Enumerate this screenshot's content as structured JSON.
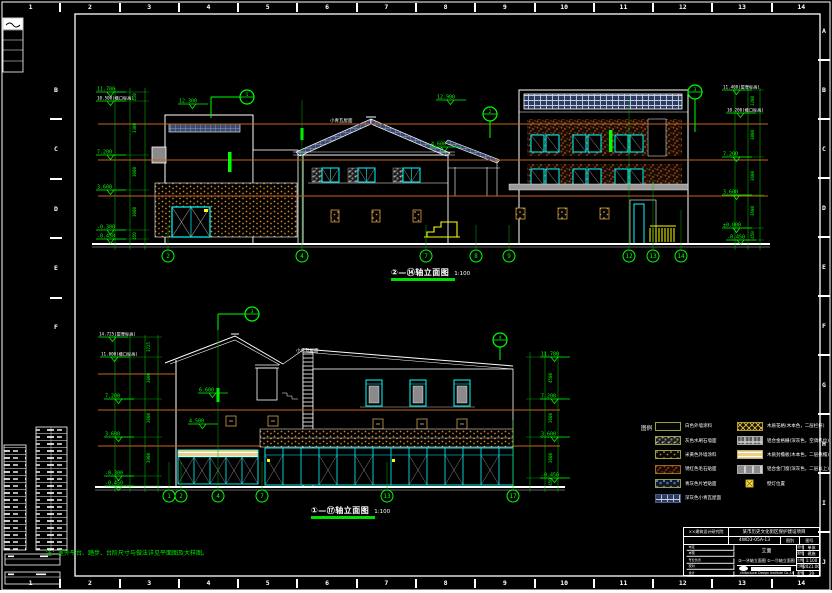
{
  "sheet": {
    "ruler_numbers": [
      "1",
      "2",
      "3",
      "4",
      "5",
      "6",
      "7",
      "8",
      "9",
      "10",
      "11",
      "12",
      "13",
      "14"
    ],
    "right_letters": [
      "A",
      "B",
      "C",
      "D",
      "E",
      "F",
      "G",
      "H",
      "I",
      "J"
    ],
    "left_letters": [
      "B",
      "C",
      "D",
      "E",
      "F"
    ]
  },
  "note": "注：室外平台、踏步、台阶尺寸与做法详见平面图及大样图。",
  "colors": {
    "annotation_green": "#00ff00",
    "window_cyan": "#00ffff",
    "floor_line_orange": "#c8641e",
    "highlight_yellow": "#ffff00"
  },
  "top_elevation": {
    "title": "②—⑭轴立面图",
    "scale": "1:100",
    "roof_label": "小青瓦屋面",
    "left_levels": [
      "11.700",
      "10.500(檐口标高)",
      "7.200",
      "3.600",
      "-0.300",
      "-0.450"
    ],
    "right_levels": [
      "11.400(屋脊标高)",
      "10.200(檐口标高)",
      "7.200",
      "3.600",
      "±0.000",
      "-0.450"
    ],
    "mid_levels": [
      "12.300",
      "12.900",
      "4.600"
    ],
    "left_dims": [
      "450",
      "3300",
      "3600",
      "3600",
      "450"
    ],
    "right_dims": [
      "1200",
      "3000",
      "3600",
      "3600",
      "450"
    ],
    "axis_labels": [
      "2",
      "4",
      "7",
      "8",
      "9",
      "12",
      "13",
      "14"
    ],
    "callout_labels": [
      "1",
      "2",
      "3"
    ]
  },
  "bottom_elevation": {
    "title": "①—⑰轴立面图",
    "scale": "1:100",
    "roof_label": "小青瓦屋面",
    "left_levels": [
      "14.725(屋脊标高)",
      "11.000(檐口标高)",
      "7.200",
      "3.600",
      "-0.300",
      "-0.450"
    ],
    "right_levels": [
      "11.700",
      "7.200",
      "3.600",
      "-0.450"
    ],
    "mid_levels": [
      "6.600",
      "4.500"
    ],
    "left_dims": [
      "3725",
      "3800",
      "3600",
      "3900"
    ],
    "right_dims": [
      "4500",
      "3600",
      "3600",
      "450"
    ],
    "axis_labels": [
      "1",
      "2",
      "4",
      "7",
      "13",
      "17"
    ],
    "callout_labels": [
      "3",
      "4"
    ]
  },
  "legend": {
    "title": "图例",
    "left": [
      {
        "swatch": "plain",
        "border": "#9aa040",
        "label": "白色外墙涂料"
      },
      {
        "swatch": "gray-speckle",
        "border": "#9aa040",
        "label": "灰色水刷石墙面"
      },
      {
        "swatch": "tan-dots",
        "border": "#9aa040",
        "label": "米黄色外墙涂料"
      },
      {
        "swatch": "brown",
        "border": "#a06a20",
        "label": "锈红色毛石贴面"
      },
      {
        "swatch": "blue-mottle",
        "border": "#9aa040",
        "label": "青灰色片岩贴面"
      },
      {
        "swatch": "blue-grid",
        "border": "#4a5a80",
        "label": "深灰色小青瓦屋面"
      }
    ],
    "right": [
      {
        "swatch": "yellow-cross",
        "border": "#b0a030",
        "label": "木质花格(木本色，二层栏杆)"
      },
      {
        "swatch": "gray-grid",
        "border": "#aaaaaa",
        "label": "铝合金格栅(深灰色，空调机位)"
      },
      {
        "swatch": "tan-band",
        "border": "#c0b070",
        "label": "木质封檐板(木本色，二层挑檐)"
      },
      {
        "swatch": "gray-solid",
        "border": "#aaaaaa",
        "label": "铝合金门窗(深灰色，二层以上)"
      },
      {
        "swatch": "lamp",
        "border": "#c8a020",
        "label": "壁灯位置",
        "small": true
      }
    ]
  },
  "title_block": {
    "company": "××建筑设计研究院",
    "project_name": "某市历史文化街区保护建设项目",
    "project_no": "4WD3-05A-13",
    "stamp_left": "图别",
    "stamp_right": "图号",
    "sign_rows": [
      {
        "label": "审定"
      },
      {
        "label": "审核"
      },
      {
        "label": "专业负责"
      },
      {
        "label": "校对"
      },
      {
        "label": "设计"
      }
    ],
    "title_line1": "立面",
    "title_line2": "②—⑭轴立面图  ①—⑰轴立面图",
    "company_en": "Architectural Design Institute Co.,Ltd.",
    "info_rows": [
      {
        "label": "设计",
        "value": "单体"
      },
      {
        "label": "图别",
        "value": "建施"
      },
      {
        "label": "比例",
        "value": "1:100"
      },
      {
        "label": "日期",
        "value": "2021.06"
      },
      {
        "label": "图号",
        "value": "29"
      }
    ]
  }
}
